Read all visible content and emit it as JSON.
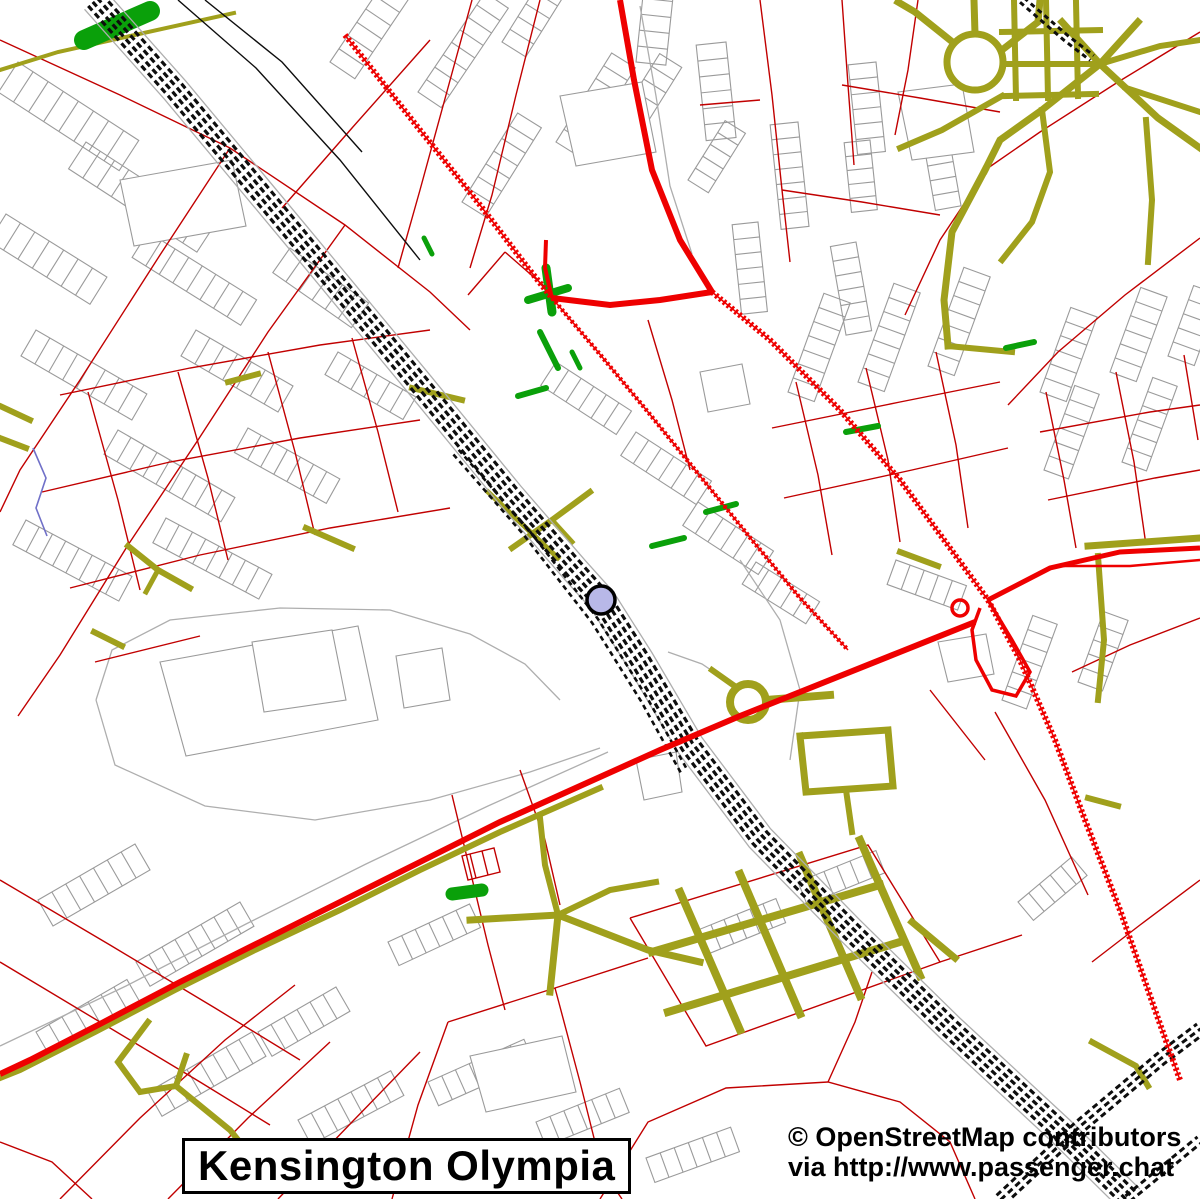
{
  "map": {
    "title": "Kensington Olympia",
    "attribution": {
      "line1": "© OpenStreetMap contributors",
      "line2": "via http://www.passenger.chat"
    },
    "marker": {
      "kind": "railway-station-marker",
      "shape": "circle"
    },
    "colors": {
      "background": "#ffffff",
      "building_outline": "#9a9a9a",
      "road_casing": "#aeaeae",
      "minor_road": "#c10000",
      "major_road": "#ee0000",
      "path": "#a0a01c",
      "railway": "#0d0d0d",
      "green_area": "#0aa00a",
      "station_marker_fill": "#b8b8e8",
      "station_marker_border": "#000000",
      "waterway": "#7070c8",
      "text": "#000000",
      "box_background": "#ffffff",
      "box_border": "#000000"
    }
  }
}
